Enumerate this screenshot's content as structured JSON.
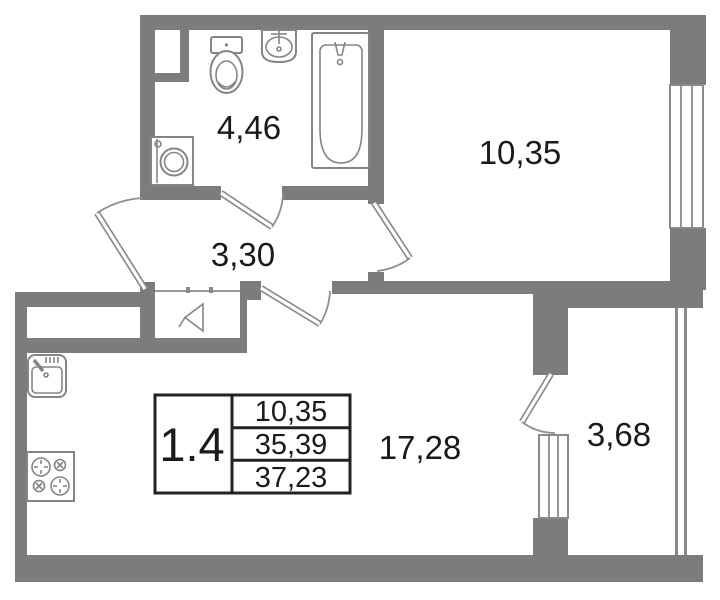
{
  "plan": {
    "type": "apartment-floor-plan",
    "unit": "1.4",
    "rooms": [
      {
        "name": "bathroom",
        "area": "4,46"
      },
      {
        "name": "bedroom",
        "area": "10,35"
      },
      {
        "name": "hallway",
        "area": "3,30"
      },
      {
        "name": "living-kitchen",
        "area": "17,28"
      },
      {
        "name": "balcony",
        "area": "3,68"
      }
    ],
    "title_block": {
      "unit": "1.4",
      "living_area": "10,35",
      "apartment_area": "35,39",
      "total_area": "37,23"
    },
    "fixtures": [
      "toilet-icon",
      "wash-basin-icon",
      "bathtub-icon",
      "washing-machine-icon",
      "kitchen-sink-icon",
      "stove-icon",
      "ventilation-icon"
    ],
    "colors": {
      "wall": "#7c7c7c",
      "fixture_outline": "#858585",
      "text": "#1a1a1a",
      "title_border": "#222222",
      "background": "#ffffff"
    }
  }
}
